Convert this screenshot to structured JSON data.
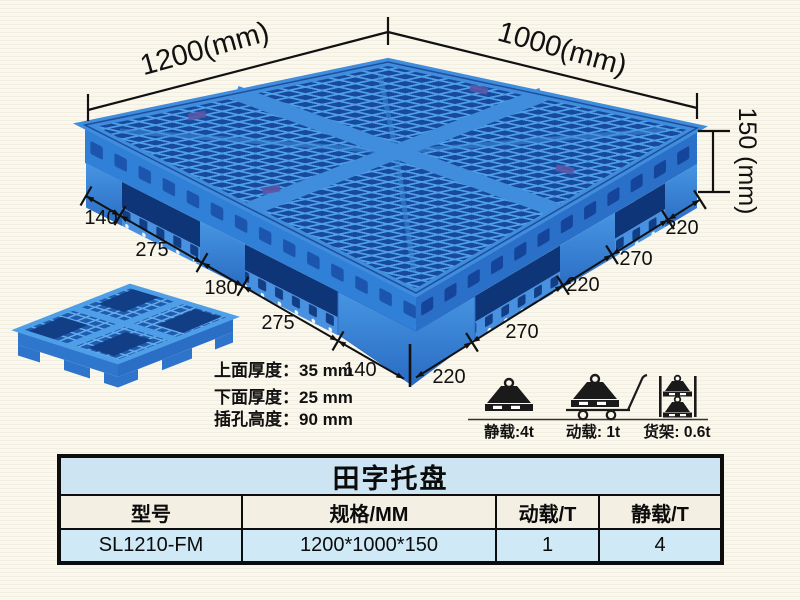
{
  "illustration": {
    "dim_length": "1200(mm)",
    "dim_width": "1000(mm)",
    "dim_height": "150 (mm)",
    "left_edge_dims": [
      "140",
      "275",
      "180",
      "275",
      "140"
    ],
    "right_edge_dims": [
      "220",
      "270",
      "220",
      "270",
      "220"
    ],
    "spec_lines": [
      "上面厚度：35 mm",
      "下面厚度：25 mm",
      "插孔高度：90 mm"
    ],
    "loads": [
      {
        "icon": "static-load-icon",
        "label": "静载:4t"
      },
      {
        "icon": "dynamic-load-icon",
        "label": "动载: 1t"
      },
      {
        "icon": "rack-load-icon",
        "label": "货架: 0.6t"
      }
    ]
  },
  "table": {
    "title": "田字托盘",
    "headers": [
      "型号",
      "规格/MM",
      "动载/T",
      "静载/T"
    ],
    "rows": [
      [
        "SL1210-FM",
        "1200*1000*150",
        "1",
        "4"
      ]
    ]
  },
  "colors": {
    "pallet_blue": "#2f7cd4",
    "pallet_dark_hole": "#123f85",
    "pallet_light_mesh": "#4f9fe8",
    "table_title_bg": "#cde4f3",
    "table_header_bg": "#f3efe3",
    "table_row_bg": "#cfe9f7",
    "line_color": "#111111"
  }
}
